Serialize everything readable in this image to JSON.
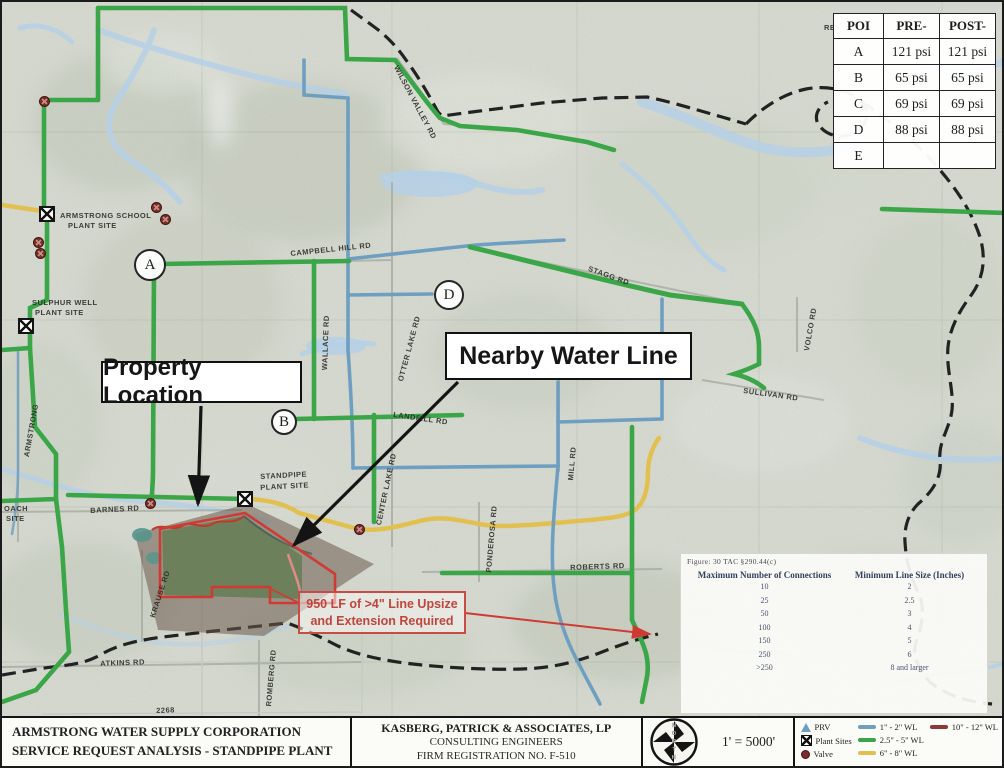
{
  "pressure_table": {
    "headers": [
      "POI",
      "PRE-",
      "POST-"
    ],
    "rows": [
      [
        "A",
        "121 psi",
        "121 psi"
      ],
      [
        "B",
        "65 psi",
        "65 psi"
      ],
      [
        "C",
        "69 psi",
        "69 psi"
      ],
      [
        "D",
        "88 psi",
        "88 psi"
      ],
      [
        "E",
        "",
        ""
      ]
    ]
  },
  "connections_table": {
    "caption": "Figure: 30 TAC §290.44(c)",
    "col1_header": "Maximum Number of Connections",
    "col2_header": "Minimum Line Size (Inches)",
    "rows": [
      [
        "10",
        "2"
      ],
      [
        "25",
        "2.5"
      ],
      [
        "50",
        "3"
      ],
      [
        "100",
        "4"
      ],
      [
        "150",
        "5"
      ],
      [
        "250",
        "6"
      ],
      [
        ">250",
        "8 and larger"
      ]
    ]
  },
  "callouts": {
    "property": "Property Location",
    "nearby": "Nearby Water Line",
    "upsize_line1": "950 LF of >4\" Line Upsize",
    "upsize_line2": "and Extension Required"
  },
  "title_block": {
    "company_line1": "ARMSTRONG WATER SUPPLY CORPORATION",
    "company_line2": "SERVICE REQUEST ANALYSIS - STANDPIPE PLANT",
    "engineer_line1": "KASBERG, PATRICK & ASSOCIATES, LP",
    "engineer_line2": "CONSULTING ENGINEERS",
    "engineer_line3": "FIRM REGISTRATION NO. F-510",
    "scale": "1' = 5000'",
    "compass_letters": "NORTH"
  },
  "legend": {
    "symbols": [
      {
        "name": "prv",
        "label": "PRV"
      },
      {
        "name": "plant",
        "label": "Plant Sites"
      },
      {
        "name": "valve",
        "label": "Valve"
      }
    ],
    "lines": [
      {
        "label": "1\" - 2\" WL",
        "color": "#6f9fc0"
      },
      {
        "label": "2.5\" - 5\" WL",
        "color": "#3aa648"
      },
      {
        "label": "6\" - 8\" WL",
        "color": "#e2c050"
      },
      {
        "label": "10\" - 12\" WL",
        "color": "#8b3a3a"
      }
    ]
  },
  "map": {
    "poi_markers": [
      {
        "label": "A",
        "x": 148,
        "y": 263,
        "r": 16
      },
      {
        "label": "B",
        "x": 282,
        "y": 420,
        "r": 13
      },
      {
        "label": "D",
        "x": 447,
        "y": 293,
        "r": 15
      }
    ],
    "plant_sites": [
      {
        "x": 45,
        "y": 212
      },
      {
        "x": 24,
        "y": 324
      },
      {
        "x": 243,
        "y": 497
      }
    ],
    "valves": [
      {
        "x": 42,
        "y": 99
      },
      {
        "x": 154,
        "y": 205
      },
      {
        "x": 163,
        "y": 217
      },
      {
        "x": 36,
        "y": 240
      },
      {
        "x": 38,
        "y": 251
      },
      {
        "x": 148,
        "y": 501
      },
      {
        "x": 357,
        "y": 527
      }
    ],
    "labels": [
      {
        "text": "ARMSTRONG SCHOOL",
        "x": 58,
        "y": 209,
        "rot": 0
      },
      {
        "text": "PLANT SITE",
        "x": 66,
        "y": 219,
        "rot": 0
      },
      {
        "text": "SULPHUR WELL",
        "x": 30,
        "y": 296,
        "rot": 0
      },
      {
        "text": "PLANT SITE",
        "x": 33,
        "y": 306,
        "rot": 0
      },
      {
        "text": "STANDPIPE",
        "x": 258,
        "y": 470,
        "rot": -3
      },
      {
        "text": "PLANT SITE",
        "x": 258,
        "y": 481,
        "rot": -3
      },
      {
        "text": "WILSON VALLEY RD",
        "x": 398,
        "y": 62,
        "rot": 62
      },
      {
        "text": "CAMPBELL HILL RD",
        "x": 288,
        "y": 247,
        "rot": -6
      },
      {
        "text": "STAGG RD",
        "x": 588,
        "y": 262,
        "rot": 20
      },
      {
        "text": "WALLACE RD",
        "x": 318,
        "y": 368,
        "rot": -88
      },
      {
        "text": "OTTER LAKE RD",
        "x": 394,
        "y": 378,
        "rot": -75
      },
      {
        "text": "CENTER LAKE RD",
        "x": 372,
        "y": 522,
        "rot": -78
      },
      {
        "text": "LANDFILL RD",
        "x": 392,
        "y": 408,
        "rot": 8
      },
      {
        "text": "MILL RD",
        "x": 564,
        "y": 478,
        "rot": -85
      },
      {
        "text": "VOLCO RD",
        "x": 800,
        "y": 348,
        "rot": -80
      },
      {
        "text": "SULLIVAN RD",
        "x": 742,
        "y": 384,
        "rot": 8
      },
      {
        "text": "BARNES RD",
        "x": 88,
        "y": 504,
        "rot": -3
      },
      {
        "text": "KRAUSE RD",
        "x": 146,
        "y": 614,
        "rot": -72
      },
      {
        "text": "ATKINS RD",
        "x": 98,
        "y": 657,
        "rot": -2
      },
      {
        "text": "ROMBERG RD",
        "x": 262,
        "y": 704,
        "rot": -85
      },
      {
        "text": "PONDEROSA RD",
        "x": 482,
        "y": 570,
        "rot": -85
      },
      {
        "text": "ROBERTS RD",
        "x": 568,
        "y": 561,
        "rot": -2
      },
      {
        "text": "ARMSTRONG",
        "x": 20,
        "y": 454,
        "rot": -80
      },
      {
        "text": "2268",
        "x": 154,
        "y": 704,
        "rot": -2
      },
      {
        "text": "OACH",
        "x": 2,
        "y": 502,
        "rot": 0
      },
      {
        "text": "SITE",
        "x": 4,
        "y": 512,
        "rot": 0
      },
      {
        "text": "RE",
        "x": 822,
        "y": 21,
        "rot": 0
      }
    ]
  },
  "colors": {
    "wl_small": "#6f9fc0",
    "wl_medium": "#3aa648",
    "wl_large": "#e2c050",
    "wl_xlarge": "#8b3a3a",
    "boundary": "#222222",
    "annotation_red": "#cf3b32",
    "creek": "#b5d0e6"
  }
}
